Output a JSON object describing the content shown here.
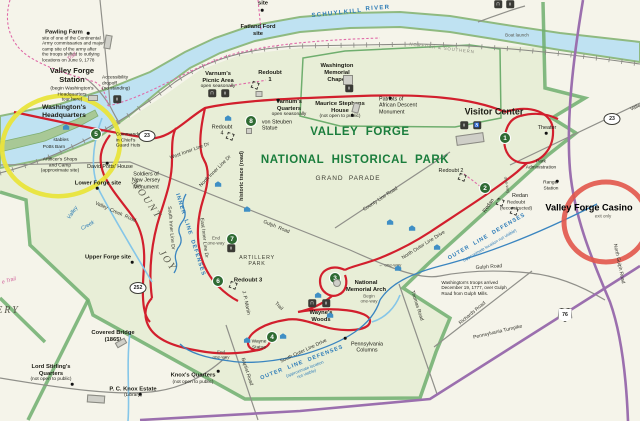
{
  "map_title": "Valley Forge National Historical Park map",
  "colors": {
    "park_fill": "#e8eed7",
    "outside_fill": "#f5f4ea",
    "boundary_green": "#6fae6e",
    "tour_road_red": "#d21f2d",
    "highway_purple": "#9b6fae",
    "water_blue": "#bfe2f2",
    "title_green": "#1a7d3c",
    "defense_blue": "#2e7cb8",
    "trail_pink": "#e06aa8",
    "annotation_yellow": "#e9e43c",
    "annotation_red": "#e2574b"
  },
  "labels": [
    {
      "t": "site",
      "x": 263,
      "y": 4,
      "c": "poi-b"
    },
    {
      "t": "SCHUYLKILL",
      "x": 337,
      "y": 14,
      "c": "river",
      "r": -6
    },
    {
      "t": "RIVER",
      "x": 378,
      "y": 9,
      "c": "river",
      "r": -4
    },
    {
      "t": "Fatland Ford\nsite",
      "x": 258,
      "y": 31,
      "c": "poi-b"
    },
    {
      "t": "Pawling Farm",
      "x": 64,
      "y": 33,
      "c": "poi-b"
    },
    {
      "t": "site of one of the Continental\nArmy commissaries and major\ncamp site of the army after\nthe troops shifted to outlying\nlocations on June 9, 1778",
      "x": 73,
      "y": 49,
      "c": "desc"
    },
    {
      "t": "Trail",
      "x": 72,
      "y": 57,
      "c": "pink",
      "r": -38
    },
    {
      "t": "Valley Forge\nStation",
      "x": 72,
      "y": 76,
      "c": "station"
    },
    {
      "t": "(begin Washington's\nHeadquarters\ntour here)",
      "x": 72,
      "y": 95,
      "c": "tiny"
    },
    {
      "t": "Accessibility\ndropoff\n(no standing)",
      "x": 116,
      "y": 84,
      "c": "tiny l"
    },
    {
      "t": "Washington's\nHeadquarters",
      "x": 64,
      "y": 112,
      "c": "hq"
    },
    {
      "t": "Commander\nin Chief's\nGuard Huts",
      "x": 129,
      "y": 141,
      "c": "tiny l"
    },
    {
      "t": "stables",
      "x": 61,
      "y": 141,
      "c": "tiny"
    },
    {
      "t": "Potts Barn",
      "x": 54,
      "y": 148,
      "c": "tiny"
    },
    {
      "t": "Artificer's Shops\nand Camp\n(approximate site)",
      "x": 60,
      "y": 166,
      "c": "tiny"
    },
    {
      "t": "David Potts' House",
      "x": 110,
      "y": 167,
      "c": "poi"
    },
    {
      "t": "Lower Forge site",
      "x": 98,
      "y": 184,
      "c": "poi-b"
    },
    {
      "t": "Soldiers of\nNew Jersey\nMonument",
      "x": 146,
      "y": 181,
      "c": "poi"
    },
    {
      "t": "Varnum's\nPicnic Area",
      "x": 218,
      "y": 78,
      "c": "poi-b"
    },
    {
      "t": "open seasonally",
      "x": 218,
      "y": 87,
      "c": "tiny"
    },
    {
      "t": "Redoubt\n1",
      "x": 270,
      "y": 77,
      "c": "poi-b"
    },
    {
      "t": "Washington\nMemorial\nChapel",
      "x": 337,
      "y": 73,
      "c": "poi-b"
    },
    {
      "t": "Varnum's\nQuarters",
      "x": 289,
      "y": 106,
      "c": "poi-b"
    },
    {
      "t": "open seasonally",
      "x": 289,
      "y": 115,
      "c": "tiny"
    },
    {
      "t": "von Steuben\nStatue",
      "x": 277,
      "y": 126,
      "c": "poi l"
    },
    {
      "t": "Maurice Stephens\nHouse",
      "x": 340,
      "y": 108,
      "c": "poi-b"
    },
    {
      "t": "(not open to public)",
      "x": 340,
      "y": 117,
      "c": "tiny"
    },
    {
      "t": "Patriots of\nAfrican Descent\nMonument",
      "x": 398,
      "y": 106,
      "c": "poi l"
    },
    {
      "t": "NORFOLK & SOUTHERN",
      "x": 442,
      "y": 48,
      "c": "rr",
      "r": 7
    },
    {
      "t": "Boat launch",
      "x": 517,
      "y": 35,
      "c": "gray-tiny"
    },
    {
      "t": "Visitor Center",
      "x": 494,
      "y": 112,
      "c": "vc"
    },
    {
      "t": "Theater",
      "x": 547,
      "y": 128,
      "c": "poi"
    },
    {
      "t": "Park\nAdministration",
      "x": 541,
      "y": 165,
      "c": "tiny"
    },
    {
      "t": "Ranger\nStation",
      "x": 551,
      "y": 186,
      "c": "tiny"
    },
    {
      "t": "Redoubt 2",
      "x": 451,
      "y": 171,
      "c": "poi"
    },
    {
      "t": "Redan",
      "x": 520,
      "y": 196,
      "c": "poi"
    },
    {
      "t": "Redoubt\n(reconstructed)",
      "x": 516,
      "y": 206,
      "c": "tiny"
    },
    {
      "t": "Redan",
      "x": 489,
      "y": 206,
      "c": "poi",
      "r": -55
    },
    {
      "t": "Valley Forge Casino",
      "x": 589,
      "y": 208,
      "c": "casino"
    },
    {
      "t": "exit only",
      "x": 603,
      "y": 216,
      "c": "gray-tiny"
    },
    {
      "t": "North Gulph Road",
      "x": 618,
      "y": 264,
      "c": "road",
      "r": 78
    },
    {
      "t": "Gulph Road",
      "x": 489,
      "y": 268,
      "c": "road",
      "r": -4
    },
    {
      "t": "Gulph  Road",
      "x": 276,
      "y": 228,
      "c": "road",
      "r": 22
    },
    {
      "t": "Richards Road",
      "x": 473,
      "y": 314,
      "c": "road",
      "r": -40
    },
    {
      "t": "Pennsylvania Turnpike",
      "x": 498,
      "y": 333,
      "c": "road",
      "r": -13
    },
    {
      "t": "Washington's troops arrived\nDecember 19, 1777, over Gulph\nRoad from Gulph Mills.",
      "x": 474,
      "y": 288,
      "c": "desc"
    },
    {
      "t": "Thomas Road",
      "x": 416,
      "y": 306,
      "c": "road",
      "r": 72
    },
    {
      "t": "Baptist Road",
      "x": 246,
      "y": 372,
      "c": "road",
      "r": 72
    },
    {
      "t": "County Line Road",
      "x": 381,
      "y": 200,
      "c": "road",
      "r": -33
    },
    {
      "t": "North Outer Line Drive",
      "x": 424,
      "y": 246,
      "c": "road",
      "r": -32
    },
    {
      "t": "South Outer Line Drive",
      "x": 304,
      "y": 352,
      "c": "road",
      "r": -25
    },
    {
      "t": "OUTER  LINE  DEFENSES",
      "x": 302,
      "y": 363,
      "c": "defense",
      "r": -21
    },
    {
      "t": "(approximate location\nnot visible)",
      "x": 306,
      "y": 372,
      "c": "defense-sub",
      "r": -21
    },
    {
      "t": "OUTER  LINE  DEFENSES",
      "x": 487,
      "y": 237,
      "c": "defense",
      "r": -30
    },
    {
      "t": "(approximate location not visible)",
      "x": 490,
      "y": 246,
      "c": "defense-sub",
      "r": -30
    },
    {
      "t": "INNER  LINE  DEFENSES",
      "x": 190,
      "y": 235,
      "c": "defense",
      "r": 72
    },
    {
      "t": "South Inner Line Dr",
      "x": 170,
      "y": 228,
      "c": "road",
      "r": 85
    },
    {
      "t": "East Inner Line Dr",
      "x": 203,
      "y": 238,
      "c": "road",
      "r": 83
    },
    {
      "t": "West Inner Line Dr",
      "x": 190,
      "y": 152,
      "c": "road",
      "r": -20
    },
    {
      "t": "North Inner Line Dr",
      "x": 216,
      "y": 172,
      "c": "road",
      "r": -45
    },
    {
      "t": "End\none-way",
      "x": 216,
      "y": 241,
      "c": "gray-tiny"
    },
    {
      "t": "End\none-way",
      "x": 221,
      "y": 355,
      "c": "gray-tiny"
    },
    {
      "t": "Begin\none-way",
      "x": 369,
      "y": 299,
      "c": "gray-tiny"
    },
    {
      "t": "← one-way",
      "x": 390,
      "y": 265,
      "c": "gray-tiny"
    },
    {
      "t": "one-way",
      "x": 507,
      "y": 185,
      "c": "gray-tiny",
      "r": 80
    },
    {
      "t": "historic trace (road)",
      "x": 242,
      "y": 176,
      "c": "trace",
      "r": -90
    },
    {
      "t": "ARTILLERY\nPARK",
      "x": 257,
      "y": 261,
      "c": "artpark"
    },
    {
      "t": "Redoubt 3",
      "x": 248,
      "y": 281,
      "c": "poi-b"
    },
    {
      "t": "Redoubt\n4",
      "x": 222,
      "y": 131,
      "c": "poi"
    },
    {
      "t": "MOUNT",
      "x": 146,
      "y": 200,
      "c": "mount",
      "r": 55
    },
    {
      "t": "JOY",
      "x": 167,
      "y": 261,
      "c": "mount",
      "r": 55
    },
    {
      "t": "ERY",
      "x": 8,
      "y": 311,
      "c": "mount"
    },
    {
      "t": "Valley",
      "x": 73,
      "y": 213,
      "c": "creek",
      "r": -55
    },
    {
      "t": "Creek",
      "x": 88,
      "y": 226,
      "c": "creek",
      "r": -30
    },
    {
      "t": "Valley  Creek  Road",
      "x": 115,
      "y": 213,
      "c": "road",
      "r": 24
    },
    {
      "t": "Upper Forge site",
      "x": 108,
      "y": 258,
      "c": "poi-b"
    },
    {
      "t": "Covered Bridge\n(1865)",
      "x": 113,
      "y": 337,
      "c": "poi-b"
    },
    {
      "t": "Lord Stirling's\nQuarters",
      "x": 51,
      "y": 371,
      "c": "poi-b"
    },
    {
      "t": "(not open to public)",
      "x": 51,
      "y": 380,
      "c": "tiny"
    },
    {
      "t": "P. C. Knox Estate",
      "x": 133,
      "y": 390,
      "c": "poi-b"
    },
    {
      "t": "(Library)",
      "x": 133,
      "y": 396,
      "c": "tiny"
    },
    {
      "t": "Knox's Quarters",
      "x": 193,
      "y": 376,
      "c": "poi-b"
    },
    {
      "t": "(not open to public)",
      "x": 193,
      "y": 383,
      "c": "tiny"
    },
    {
      "t": "Wayne\nStatue",
      "x": 259,
      "y": 345,
      "c": "tiny"
    },
    {
      "t": "Wayne's\nWoods",
      "x": 321,
      "y": 317,
      "c": "poi-b"
    },
    {
      "t": "Pennsylvania\nColumns",
      "x": 367,
      "y": 348,
      "c": "poi"
    },
    {
      "t": "National\nMemorial Arch",
      "x": 366,
      "y": 287,
      "c": "poi-b"
    },
    {
      "t": "J. P. Martin",
      "x": 245,
      "y": 303,
      "c": "road",
      "r": 78
    },
    {
      "t": "Trail",
      "x": 278,
      "y": 307,
      "c": "road",
      "r": 45
    },
    {
      "t": "VALLEY  FORGE",
      "x": 360,
      "y": 133,
      "c": "title"
    },
    {
      "t": "NATIONAL  HISTORICAL  PARK",
      "x": 355,
      "y": 161,
      "c": "title"
    },
    {
      "t": "GRAND  PARADE",
      "x": 348,
      "y": 179,
      "c": "parade"
    },
    {
      "t": "Valley",
      "x": 637,
      "y": 108,
      "c": "road",
      "r": -24
    },
    {
      "t": "e Trail",
      "x": 9,
      "y": 281,
      "c": "pink",
      "r": -15
    }
  ],
  "markers": {
    "stops": [
      {
        "n": "1",
        "x": 505,
        "y": 138
      },
      {
        "n": "2",
        "x": 485,
        "y": 188
      },
      {
        "n": "3",
        "x": 335,
        "y": 278
      },
      {
        "n": "4",
        "x": 272,
        "y": 337
      },
      {
        "n": "5",
        "x": 96,
        "y": 134
      },
      {
        "n": "6",
        "x": 218,
        "y": 281
      },
      {
        "n": "7",
        "x": 232,
        "y": 239
      },
      {
        "n": "8",
        "x": 251,
        "y": 121
      }
    ],
    "shields": [
      {
        "n": "23",
        "x": 147,
        "y": 136
      },
      {
        "n": "23",
        "x": 612,
        "y": 119
      },
      {
        "n": "252",
        "x": 138,
        "y": 288
      }
    ],
    "interstate_shields": [
      {
        "n": "76",
        "x": 565,
        "y": 315
      }
    ],
    "icons": [
      {
        "g": "picnic",
        "x": 212,
        "y": 93
      },
      {
        "g": "wc",
        "x": 225,
        "y": 93
      },
      {
        "g": "wc",
        "x": 117,
        "y": 99
      },
      {
        "g": "wc",
        "x": 464,
        "y": 125
      },
      {
        "g": "acc",
        "x": 477,
        "y": 125
      },
      {
        "g": "picnic",
        "x": 312,
        "y": 303
      },
      {
        "g": "wc",
        "x": 326,
        "y": 303
      },
      {
        "g": "wc",
        "x": 231,
        "y": 248
      },
      {
        "g": "wc",
        "x": 349,
        "y": 88
      },
      {
        "g": "picnic",
        "x": 498,
        "y": 4
      },
      {
        "g": "wc",
        "x": 510,
        "y": 4
      }
    ],
    "icon_glyphs": {
      "picnic": "⊓",
      "wc": "ii",
      "acc": "♿"
    },
    "huts": [
      {
        "x": 66,
        "y": 127
      },
      {
        "x": 228,
        "y": 118
      },
      {
        "x": 218,
        "y": 184
      },
      {
        "x": 247,
        "y": 209
      },
      {
        "x": 390,
        "y": 222
      },
      {
        "x": 412,
        "y": 228
      },
      {
        "x": 437,
        "y": 247
      },
      {
        "x": 330,
        "y": 315
      },
      {
        "x": 283,
        "y": 336
      },
      {
        "x": 247,
        "y": 340
      },
      {
        "x": 318,
        "y": 295
      },
      {
        "x": 398,
        "y": 268
      }
    ],
    "forts": [
      {
        "x": 255,
        "y": 85
      },
      {
        "x": 462,
        "y": 177
      },
      {
        "x": 230,
        "y": 136
      },
      {
        "x": 233,
        "y": 285
      },
      {
        "x": 500,
        "y": 202
      },
      {
        "x": 514,
        "y": 211
      }
    ],
    "dots": [
      {
        "x": 88,
        "y": 33
      },
      {
        "x": 107,
        "y": 163
      },
      {
        "x": 132,
        "y": 262
      },
      {
        "x": 72,
        "y": 384
      },
      {
        "x": 140,
        "y": 394
      },
      {
        "x": 218,
        "y": 371
      },
      {
        "x": 390,
        "y": 98
      },
      {
        "x": 352,
        "y": 115
      },
      {
        "x": 546,
        "y": 133
      },
      {
        "x": 557,
        "y": 181
      },
      {
        "x": 278,
        "y": 100
      },
      {
        "x": 345,
        "y": 338
      },
      {
        "x": 97,
        "y": 188
      },
      {
        "x": 262,
        "y": 10
      }
    ],
    "buildings": [
      {
        "x": 108,
        "y": 42,
        "w": 5,
        "h": 12,
        "r": 10
      },
      {
        "x": 470,
        "y": 139,
        "w": 26,
        "h": 8,
        "r": -8
      },
      {
        "x": 348,
        "y": 80,
        "w": 8,
        "h": 8,
        "r": 0
      },
      {
        "x": 93,
        "y": 98,
        "w": 8,
        "h": 4,
        "r": 0
      },
      {
        "x": 356,
        "y": 108,
        "w": 5,
        "h": 8,
        "r": 15
      },
      {
        "x": 121,
        "y": 343,
        "w": 9,
        "h": 4,
        "r": -30
      },
      {
        "x": 96,
        "y": 399,
        "w": 16,
        "h": 6,
        "r": 4
      },
      {
        "x": 259,
        "y": 94,
        "w": 5,
        "h": 4,
        "r": 0
      },
      {
        "x": 249,
        "y": 131,
        "w": 4,
        "h": 4,
        "r": 0
      },
      {
        "x": 337,
        "y": 283,
        "w": 6,
        "h": 6,
        "r": 0,
        "round": true
      }
    ]
  },
  "annotations": {
    "yellow_circle_target": "Washington's Headquarters / Valley Forge Station area",
    "red_circle_target": "Valley Forge Casino"
  }
}
